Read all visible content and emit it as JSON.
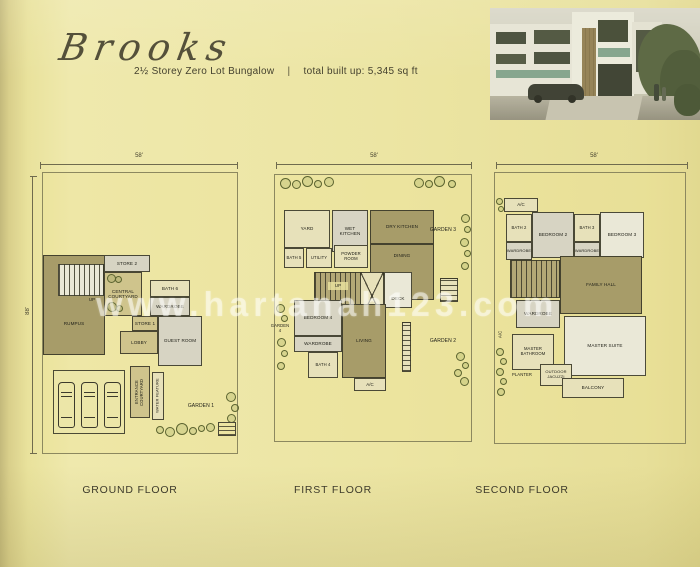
{
  "header": {
    "title": "Brooks",
    "type_line": "2½ Storey Zero Lot Bungalow",
    "separator": "|",
    "built_up": "total built up: 5,345 sq ft"
  },
  "watermark": "www.hartanah123.com",
  "colors": {
    "page_bg": "#ebe49f",
    "room_dark_olive": "#a79c69",
    "room_tan": "#cfc48c",
    "room_gray": "#d7d4c3",
    "room_pale": "#e7e1ba",
    "wall": "#3c3a2c"
  },
  "plans": {
    "ground": {
      "label": "GROUND FLOOR",
      "dim_top": "58'",
      "dim_left": "88'",
      "rooms": {
        "rumpus": "RUMPUS",
        "up": "UP",
        "store2": "STORE 2",
        "central_courtyard": "CENTRAL COURTYARD",
        "bath6": "BATH 6",
        "wardrobe": "WARDROBE",
        "store1": "STORE 1",
        "lobby": "LOBBY",
        "guest_room": "GUEST ROOM",
        "entrance_courtyard": "ENTRANCE COURTYARD",
        "water_feature": "WATER FEATURE",
        "garden1": "GARDEN 1"
      }
    },
    "first": {
      "label": "FIRST FLOOR",
      "dim_top": "58'",
      "rooms": {
        "yard": "YARD",
        "wet_kitchen": "WET KITCHEN",
        "dry_kitchen": "DRY KITCHEN",
        "dining": "DINING",
        "bath5": "BATH 5",
        "utility": "UTILITY",
        "powder_room": "POWDER ROOM",
        "garden3": "GARDEN 3",
        "up": "UP",
        "deck": "DECK",
        "bedroom4": "BEDROOM 4",
        "wardrobe": "WARDROBE",
        "bath4": "BATH 4",
        "living": "LIVING",
        "garden4": "GARDEN 4",
        "garden2": "GARDEN 2",
        "ac": "A/C"
      }
    },
    "second": {
      "label": "SECOND FLOOR",
      "dim_top": "58'",
      "rooms": {
        "ac_top": "A/C",
        "bath2": "BATH 2",
        "bedroom2": "BEDROOM 2",
        "bath3": "BATH 3",
        "bedroom3": "BEDROOM 3",
        "wardrobe_left": "WARDROBE",
        "wardrobe_right": "WARDROBE",
        "family_hall": "FAMILY HALL",
        "wardrobe_master": "WARDROBE",
        "master_suite": "MASTER SUITE",
        "master_bathroom": "MASTER BATHROOM",
        "planter": "PLANTER",
        "outdoor_jacuzzi": "OUTDOOR JACUZZI",
        "balcony": "BALCONY",
        "ac_left": "A/C"
      }
    }
  }
}
